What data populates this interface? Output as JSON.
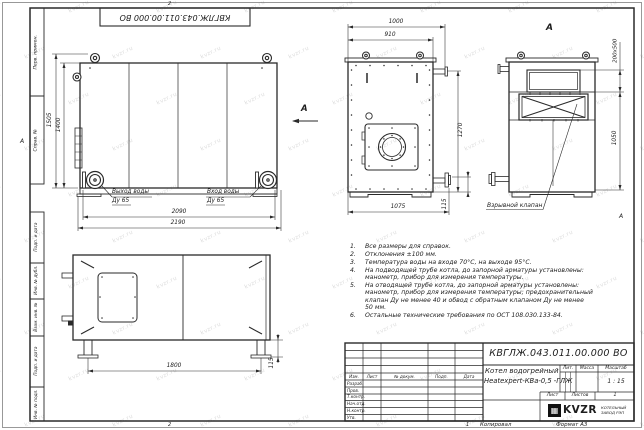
{
  "watermark": {
    "text": "kvzr.ru"
  },
  "frame": {
    "corner_stamp": "КВГЛЖ.043.011.00.000 ВО",
    "zones": {
      "top": "2",
      "bottom": "2",
      "bottom_sheet": "1",
      "left": "А",
      "right": "А"
    },
    "footer": {
      "copied": "Копировал",
      "format": "Формат А3"
    },
    "left_boxes": [
      {
        "label": "Перв. примен."
      },
      {
        "label": "Справ. №"
      },
      {
        "label": "Подп. и дата"
      },
      {
        "label": "Инв. № дубл."
      },
      {
        "label": "Взам. инв. №"
      },
      {
        "label": "Подп. и дата"
      },
      {
        "label": "Инв. № подл."
      }
    ]
  },
  "views": {
    "side": {
      "dims": {
        "height_overall": "1505",
        "height_body": "1400",
        "length_inner": "2090",
        "length_overall": "2190"
      },
      "outlet_label": "Выход воды",
      "outlet_dn": "Ду 65",
      "inlet_label": "Вход воды",
      "inlet_dn": "Ду 65",
      "arrow_label": "А"
    },
    "front": {
      "dims": {
        "width_overall": "1000",
        "width_body": "910",
        "height": "1270",
        "width_base": "1075",
        "pipe_offset": "115"
      }
    },
    "rear": {
      "title": "А",
      "dims": {
        "opening": "200х500",
        "height": "1050"
      },
      "valve_label": "Взрывной клапан"
    },
    "top": {
      "dims": {
        "leg_span": "1800",
        "leg_offset": "115"
      }
    }
  },
  "notes": {
    "items": [
      {
        "num": "1.",
        "text": "Все размеры для справок."
      },
      {
        "num": "2.",
        "text": "Отклонения ±100 мм."
      },
      {
        "num": "3.",
        "text": "Температура воды на входе 70°С, на выходе 95°С."
      },
      {
        "num": "4.",
        "text": "На подводящей трубе котла, до запорной арматуры установлены:\nманометр, прибор для измерения температуры."
      },
      {
        "num": "5.",
        "text": "На отводящей трубе котла, до запорной арматуры установлены:\nманометр, прибор для измерения температуры; предохранительный\nклапан Ду не менее 40 и обвод с обратным клапаном Ду не менее\n50 мм."
      },
      {
        "num": "6.",
        "text": "Остальные технические требования по ОСТ 108.030.133-84."
      }
    ]
  },
  "title_block": {
    "designation": "КВГЛЖ.043.011.00.000 ВО",
    "doc_name_line1": "Котел водогрейный",
    "doc_name_line2": "Heatexpert-КВа-0,5 -ГЛЖ",
    "columns": {
      "izm": "Изм.",
      "list": "Лист",
      "doc": "№ докум.",
      "sign": "Подп.",
      "date": "Дата"
    },
    "rows": [
      {
        "label": "Разраб."
      },
      {
        "label": "Пров."
      },
      {
        "label": "Т.контр."
      },
      {
        "label": "Нач.отд."
      },
      {
        "label": "Н.контр."
      },
      {
        "label": "Утв."
      }
    ],
    "lit_label": "Лит.",
    "mass_label": "Масса",
    "scale_label": "Масштаб",
    "scale_value": "1 : 15",
    "sheet_label": "Лист",
    "sheets_label": "Листов",
    "sheets_value": "1",
    "org": {
      "logo": "KVZR",
      "name_line1": "КОТЕЛЬНЫЙ",
      "name_line2": "ЗАВОД РЭП"
    }
  },
  "colors": {
    "line": "#2a2a2a",
    "watermark": "#8f8f8f"
  }
}
